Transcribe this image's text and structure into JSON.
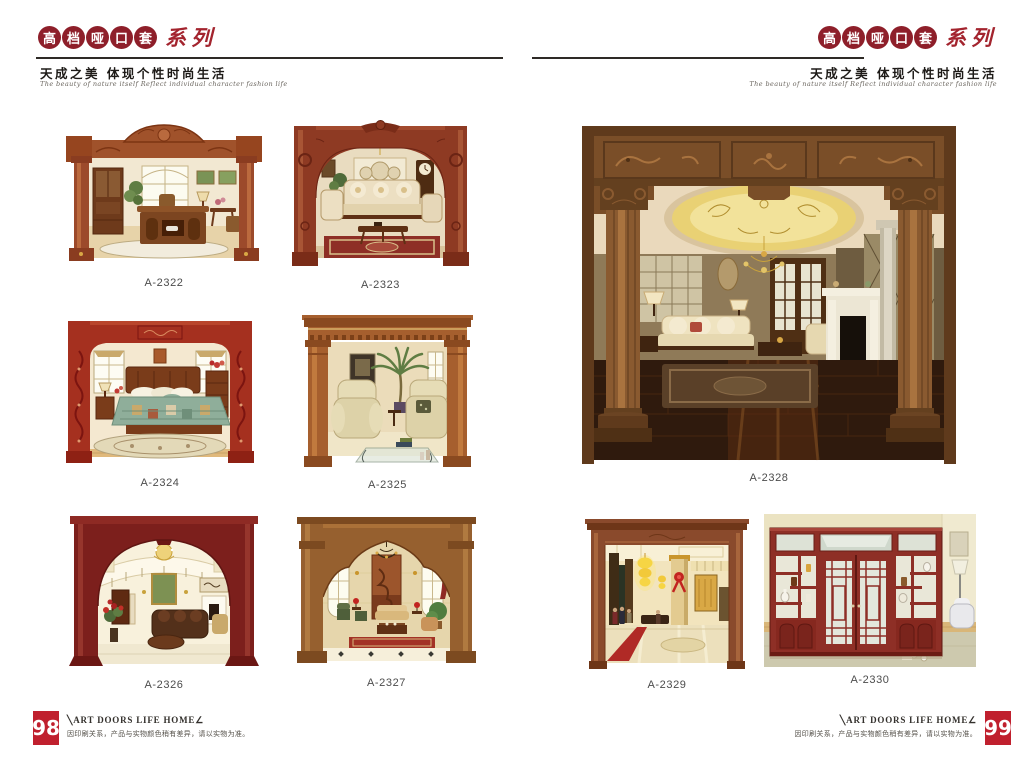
{
  "header": {
    "logo_chars": [
      "高",
      "档",
      "哑",
      "口",
      "套"
    ],
    "logo_suffix": "系列",
    "tagline": "天成之美 体现个性时尚生活",
    "tagline_en": "The beauty of nature itself Reflect individual character fashion life",
    "accent_color": "#8e1f2a"
  },
  "products": [
    {
      "code": "A-2322",
      "alt": "Carved wood archway with side columns framing a classic study room"
    },
    {
      "code": "A-2323",
      "alt": "Red-brown round-arch doorway framing a classic living room with sofas"
    },
    {
      "code": "A-2324",
      "alt": "Ornate carved red archway framing a bedroom with green quilt bed"
    },
    {
      "code": "A-2325",
      "alt": "Golden oak squared door frame with dentil cornice framing recliner sofas"
    },
    {
      "code": "A-2326",
      "alt": "Deep burgundy wide arch framing a two-storey hall with chandelier"
    },
    {
      "code": "A-2327",
      "alt": "Golden wood shaped-arch frame framing an elegant lounge with arched windows"
    },
    {
      "code": "A-2328",
      "alt": "Large carved walnut archway with round columns framing a luxury parlour"
    },
    {
      "code": "A-2329",
      "alt": "Plain wood door frame framing a golden hotel lobby with lanterns"
    },
    {
      "code": "A-2330",
      "alt": "Mahogany room divider with frosted glass doors and display shelves"
    }
  ],
  "footer": {
    "brand": "╲ART DOORS LIFE HOME∠",
    "disclaimer": "因印刷关系，产品与实物颜色稍有差异，请以实物为准。",
    "left_page": "98",
    "right_page": "99",
    "page_box_color": "#c0202e"
  }
}
